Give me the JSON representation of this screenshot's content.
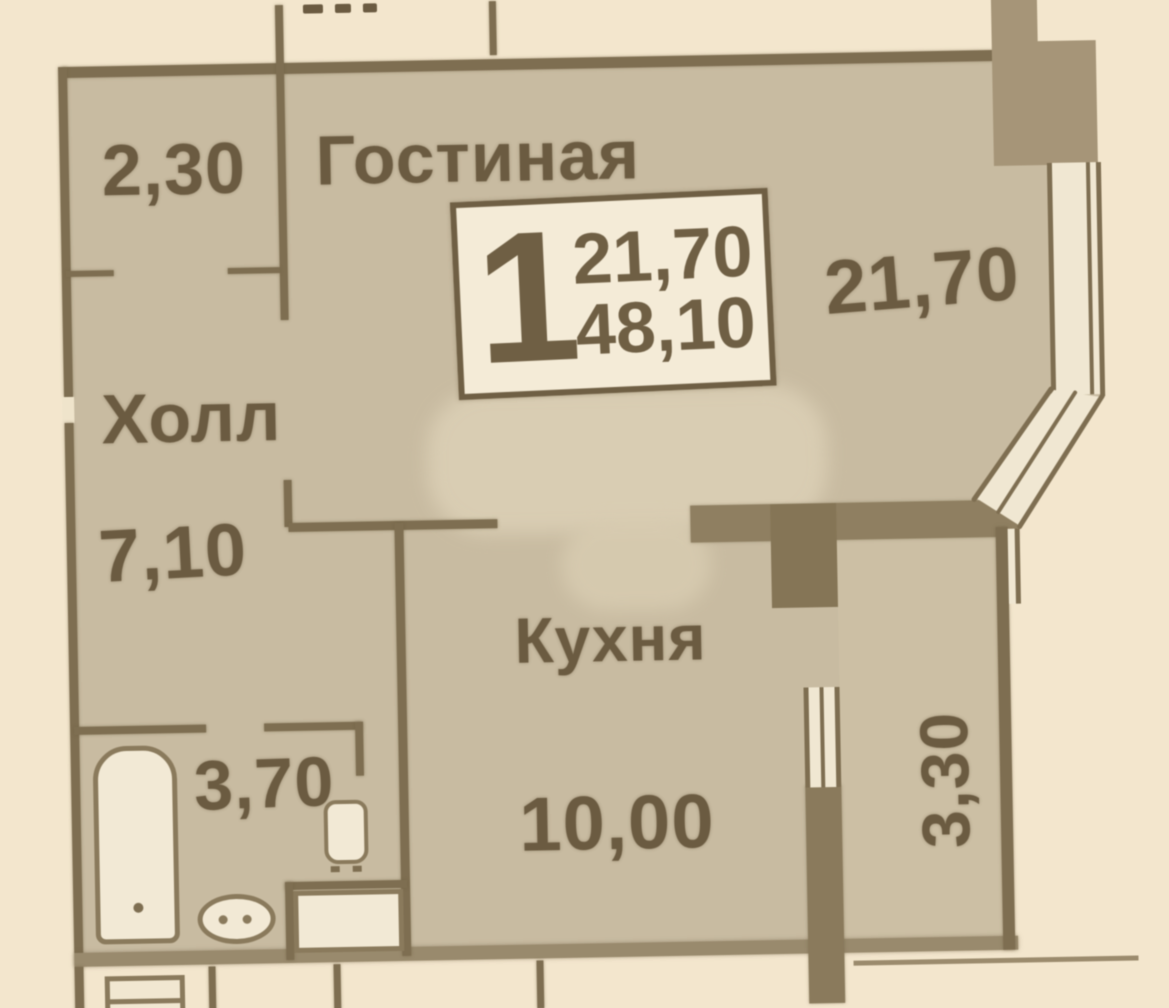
{
  "document": {
    "type": "apartment floor plan scan"
  },
  "unit_info_box": {
    "room_count": "1",
    "living_area": "21,70",
    "total_area": "48,10"
  },
  "rooms": {
    "living": {
      "name": "Гостиная",
      "area": "21,70"
    },
    "hall": {
      "name": "Холл",
      "area": "7,10",
      "upper_section_width": "2,30"
    },
    "kitchen": {
      "name": "Кухня",
      "area": "10,00"
    },
    "bathroom": {
      "area": "3,70"
    },
    "loggia": {
      "area": "3,30"
    }
  },
  "colors": {
    "page": "#f3e6cd",
    "floor": "#c8bba1",
    "wall_line": "#7e6e51",
    "wall_thick": "#8f7f61",
    "pier": "#a69578",
    "fixture_fill": "#f2e9d5",
    "ink": "#6b5b41"
  }
}
